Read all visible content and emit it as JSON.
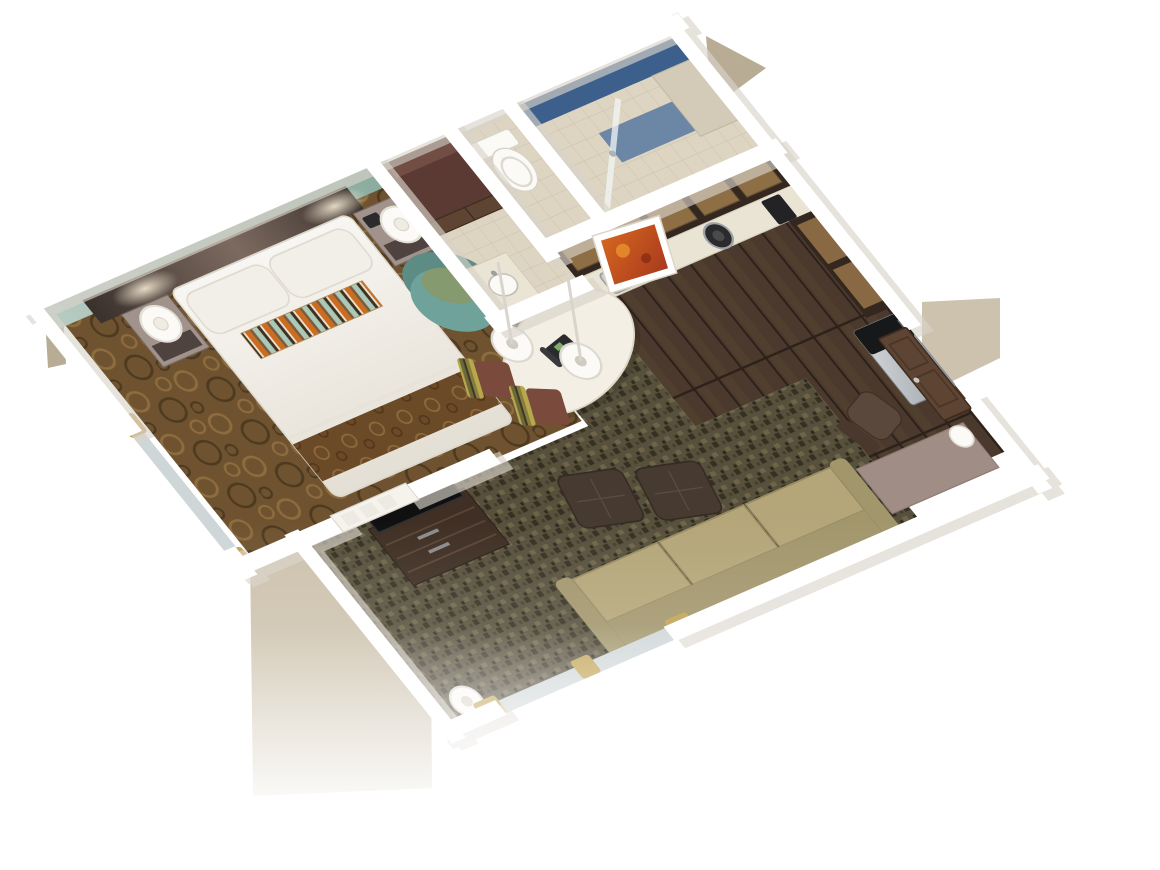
{
  "scene": {
    "type": "isometric-3d-floorplan-render",
    "rooms": [
      {
        "name": "bedroom",
        "furniture": [
          "king-bed",
          "pillows",
          "striped-accent-pillow",
          "bed-scarf",
          "nightstand-left",
          "nightstand-right",
          "table-lamp-left",
          "table-lamp-right",
          "accent-armchair",
          "white-closet-door",
          "window-curtains"
        ]
      },
      {
        "name": "closet",
        "furniture": [
          "wood-double-doors",
          "shelf"
        ]
      },
      {
        "name": "vanity",
        "furniture": [
          "vanity-counter",
          "sink"
        ]
      },
      {
        "name": "toilet-room",
        "furniture": [
          "toilet"
        ]
      },
      {
        "name": "shower-room",
        "furniture": [
          "blue-tile-shower",
          "bench",
          "glass-door"
        ]
      },
      {
        "name": "kitchen",
        "furniture": [
          "upper-cabinets",
          "counter",
          "kitchen-sink",
          "cooktop",
          "coffee-maker",
          "refrigerator",
          "east-cabinets"
        ]
      },
      {
        "name": "dining-bar",
        "furniture": [
          "oval-bar-table",
          "bar-chair-1",
          "bar-chair-2",
          "pendant-lamp-1",
          "pendant-lamp-2",
          "telephone",
          "framed-art"
        ]
      },
      {
        "name": "living-room",
        "furniture": [
          "sofa",
          "ottoman-1",
          "ottoman-2",
          "tv-dresser",
          "television",
          "floor-lamp",
          "desk",
          "office-chair",
          "desk-lamp",
          "window-curtains"
        ]
      },
      {
        "name": "entry",
        "furniture": [
          "entry-door"
        ]
      }
    ]
  },
  "colors": {
    "background": "#ffffff",
    "wall": "#ffffff",
    "wall_shadow": "#d8d3c9",
    "exterior_beige": "#cdc2ad",
    "exterior_beige_dark": "#b8ac95",
    "accent_wall_light": "#b7cbc1",
    "accent_wall_dark": "#8aab9e",
    "headboard_light": "#7c6a60",
    "headboard_dark": "#3a312c",
    "bedroom_carpet": "#6f5330",
    "carpet_ring_light": "#8d6c3e",
    "carpet_ring_dark": "#4d3a1f",
    "bedding_light": "#f8f6f2",
    "bedding_dark": "#e4dfd4",
    "pillow": "#f2efe8",
    "stripe_orange": "#cf6b1d",
    "stripe_teal": "#a9c9b9",
    "stripe_brown": "#7c5c3a",
    "stripe_dark": "#3f2f1f",
    "stripe_cream": "#e8e0d0",
    "bed_scarf": "#6b4a28",
    "nightstand": "#a2928c",
    "nightstand_dark": "#4f4340",
    "lamp": "#fbfaf6",
    "armchair": "#6fa29a",
    "armchair_dark": "#5d8c85",
    "armchair_cushion": "#879a6d",
    "living_carpet": "#57503c",
    "living_carpet_dark": "#363021",
    "living_carpet_light": "#6e6549",
    "kitchen_floor": "#4a392c",
    "plank_line": "#2c211a",
    "cabinet": "#33271f",
    "cabinet_glass": "#9d7b4c",
    "counter": "#eae4d4",
    "fridge_light": "#d9dcdf",
    "fridge_dark": "#969da3",
    "freezer": "#17181a",
    "sofa": "#b4a679",
    "sofa_back": "#a2966c",
    "ottoman": "#473b31",
    "dresser": "#3f2f24",
    "tv": "#101011",
    "desk": "#a08d86",
    "office_chair": "#5b483d",
    "door_wood": "#5d4433",
    "door_white": "#f6f3ec",
    "closet_maroon": "#5a3a33",
    "tile": "#ddd5c2",
    "tile_line": "#cdc4ae",
    "shower_blue": "#3d5f8c",
    "shower_blue_light": "#5f7da3",
    "toilet": "#fbfaf7",
    "table": "#f3efe4",
    "chair_stripe_yellow": "#b7a84a",
    "chair_seat": "#7a4a3c",
    "curtain_gold": "#c2a254",
    "glass": "#cfd6d8",
    "art_orange": "#d4651f",
    "art_red": "#a93a1e",
    "phone": "#2b2b2e"
  }
}
